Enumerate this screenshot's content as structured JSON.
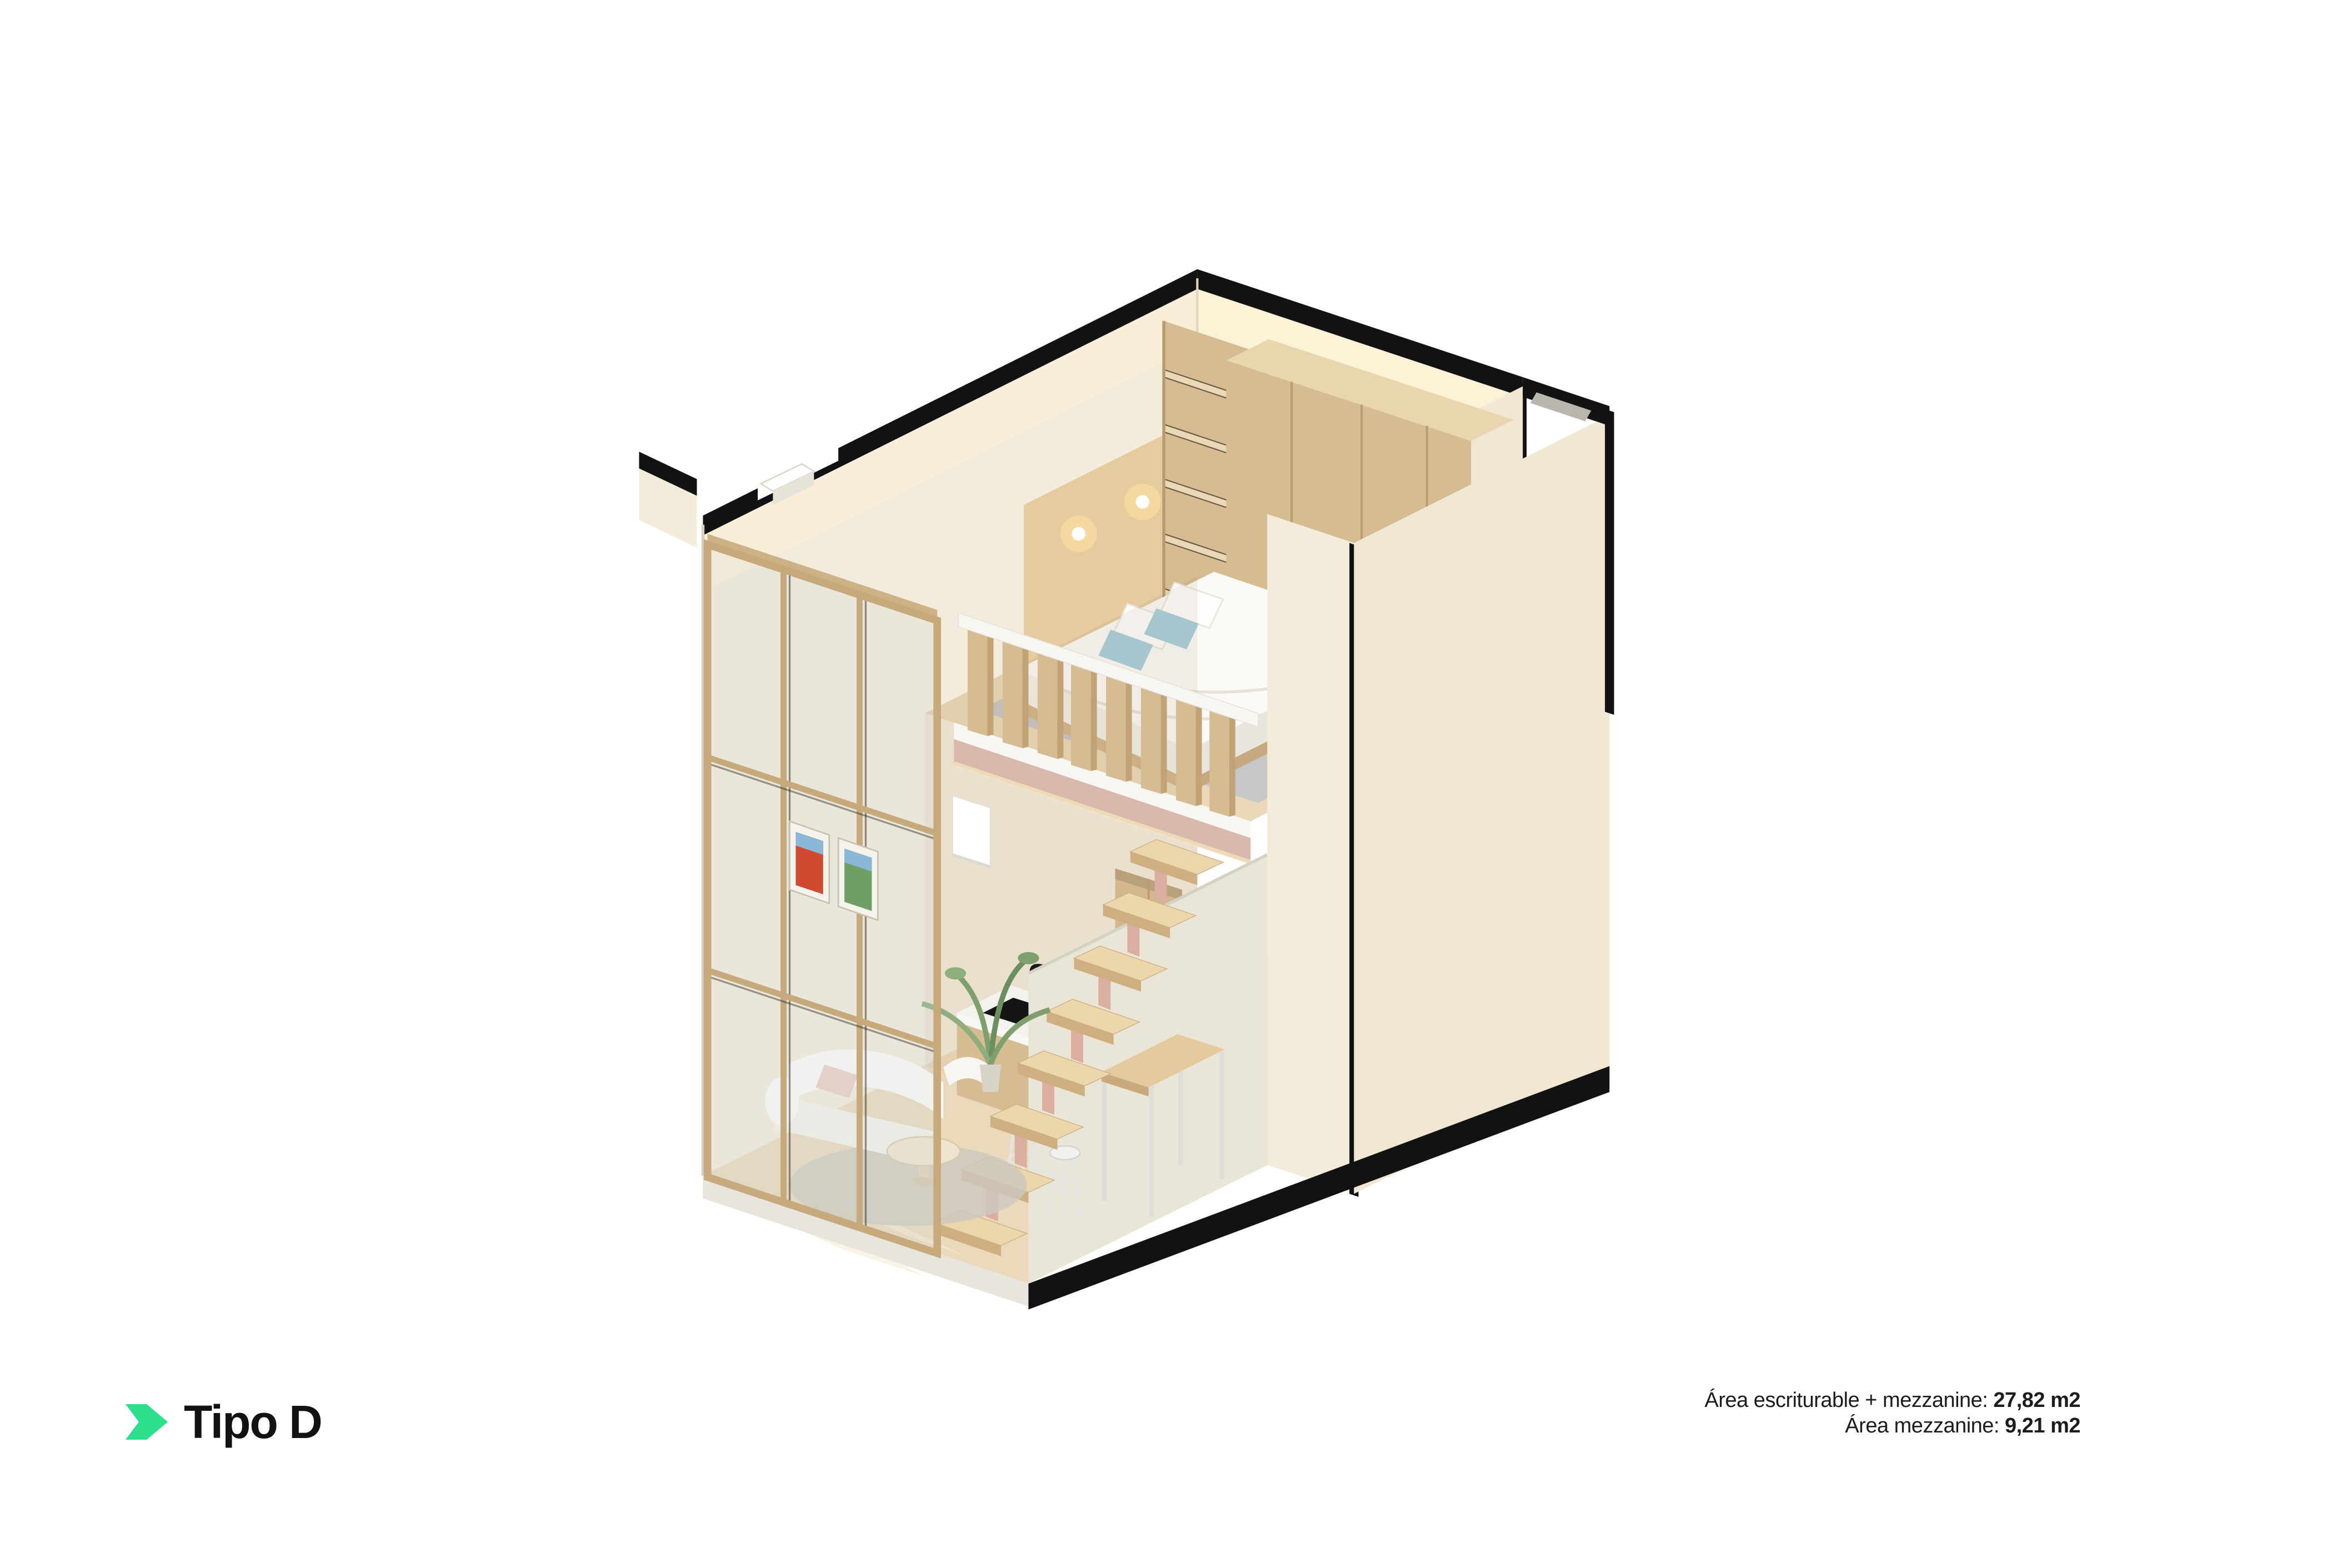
{
  "logo": {
    "text": "Tipo D",
    "chevron_color": "#2BE08C"
  },
  "footer": {
    "line1_label": "Área escriturable + mezzanine: ",
    "line1_value": "27,82 m2",
    "line2_label": "Área mezzanine: ",
    "line2_value": "9,21 m2"
  },
  "floorplan": {
    "unit_type": "Tipo D",
    "view": "isometric cutaway render of loft unit",
    "upper_level": [
      "bed with white duvet and blue pillows",
      "wood wardrobe",
      "wall shelves",
      "headboard panel with lamps",
      "gray rug",
      "wood slat railing"
    ],
    "lower_level": [
      "glass partition with wood frame",
      "two framed posters",
      "curved white sofa",
      "round coffee table",
      "round rug",
      "plant",
      "kitchen island with black sink",
      "floating wood staircase",
      "high wood table",
      "two white stools"
    ]
  },
  "palette": {
    "accent": "#2BE08C",
    "ink": "#121212",
    "textColor": "#1c1c1c",
    "wall": "#f3ecdc",
    "wallLit": "#faf0d8",
    "wallLit2": "#fcf2d6",
    "wallShade": "#f1e8d3",
    "wall2": "#f3ecdb",
    "wall3": "#f1e8d4",
    "innerWall": "#e9e5d7",
    "wood": "#d6bc92",
    "woodLight": "#e9d6ae",
    "woodDark": "#c2a376",
    "woodPale": "#e4cb9f",
    "floorTan": "#ead9bb",
    "floorMezz": "#ead8b8",
    "slabWhite": "#f8f6f0",
    "slabPink": "#d9b9ad",
    "rugGray": "#c2c5c8",
    "rugRound": "#ccc8bf",
    "white": "#fbfaf6",
    "blue": "#a9d0d9",
    "blush": "#e9cfc4",
    "glass": "#cfd8d8",
    "frame": "#c6aa7b"
  }
}
